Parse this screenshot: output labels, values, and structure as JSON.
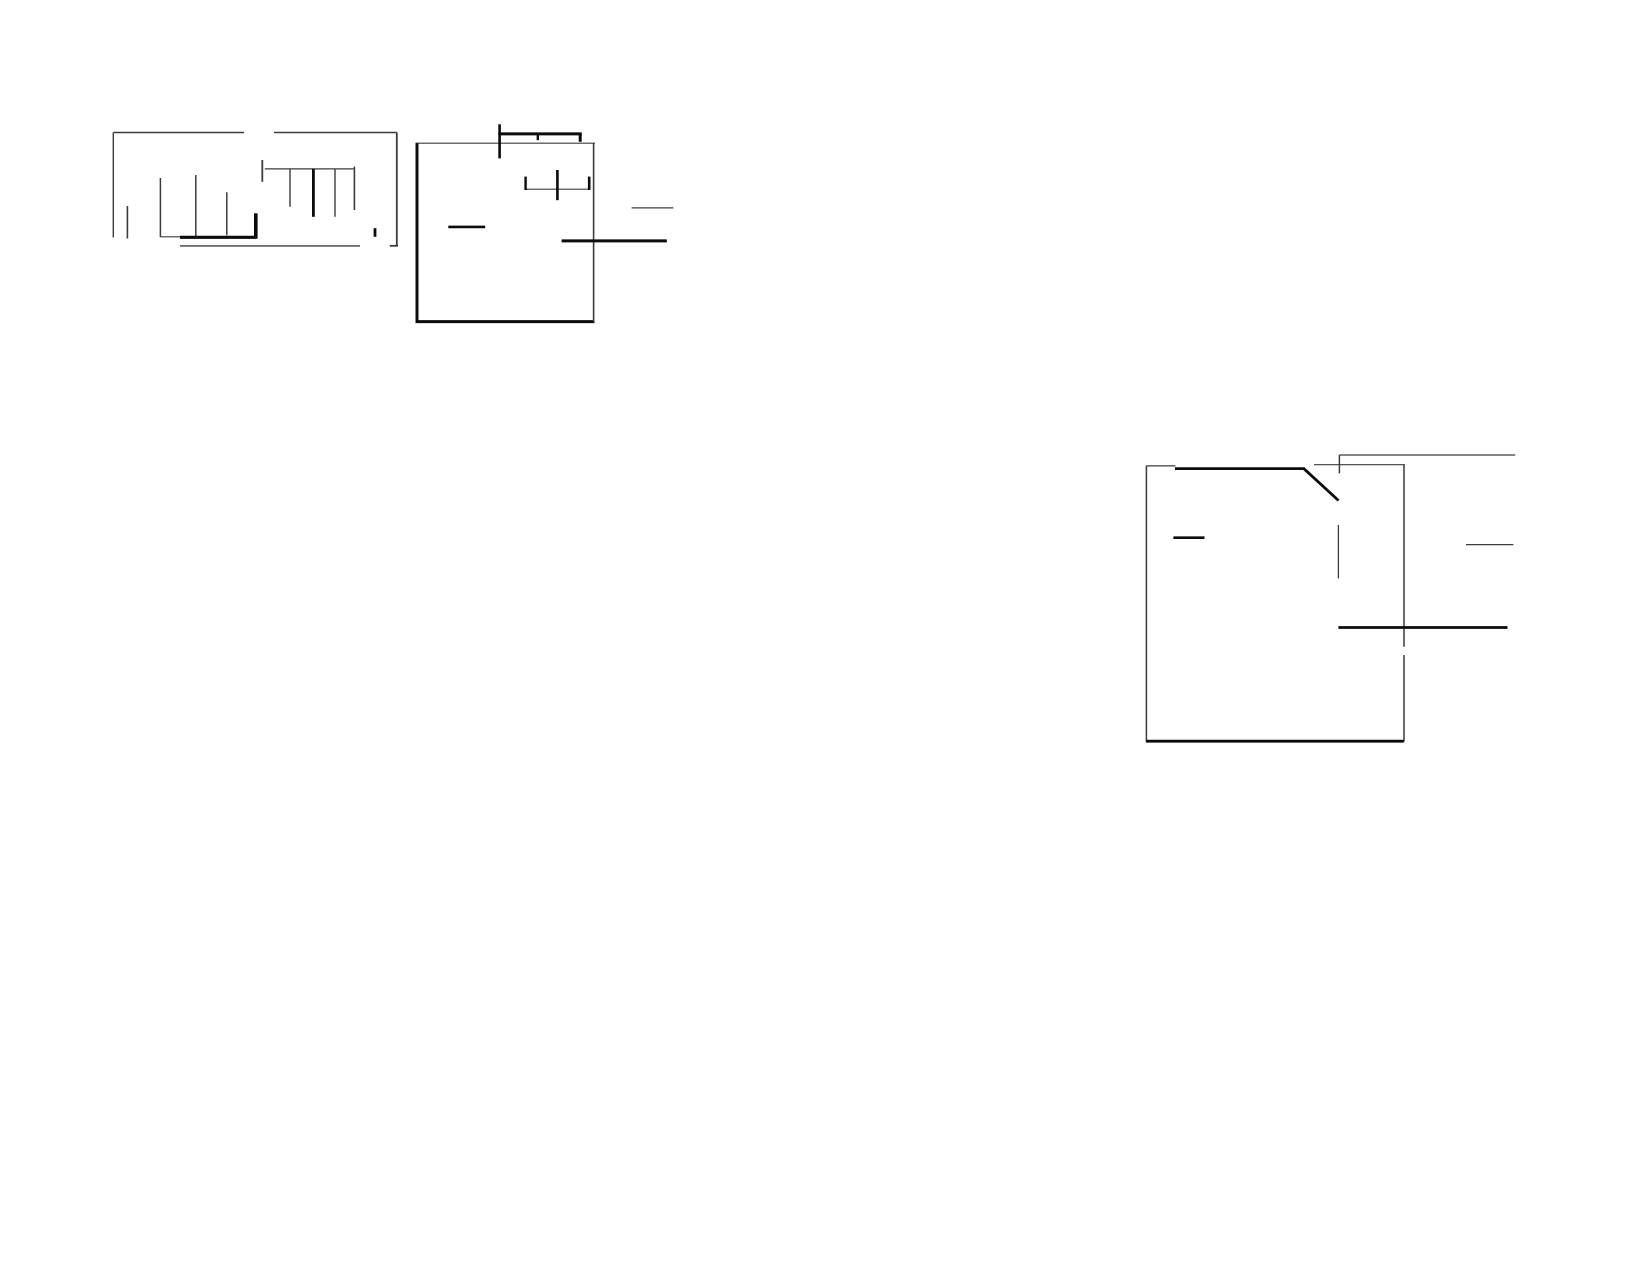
{
  "page": {
    "width": 1650,
    "height": 1275,
    "background": "#ffffff",
    "ink_thick": "#0b0b0b",
    "ink_thin": "#3c3c3c"
  },
  "figures": [
    {
      "name": "top-left-fragment",
      "segments": [
        {
          "name": "outer-top-line-left",
          "x1": 113.3,
          "y1": 132.5,
          "x2": 244.0,
          "y2": 132.5,
          "w": 1.4
        },
        {
          "name": "outer-top-line-right",
          "x1": 274.0,
          "y1": 132.5,
          "x2": 396.8,
          "y2": 132.5,
          "w": 1.4
        },
        {
          "name": "outer-left-edge",
          "x1": 113.3,
          "y1": 132.5,
          "x2": 113.3,
          "y2": 237.5,
          "w": 1.4
        },
        {
          "name": "outer-right-edge",
          "x1": 396.8,
          "y1": 132.5,
          "x2": 396.8,
          "y2": 246.3,
          "w": 1.8
        },
        {
          "name": "outer-right-bottom-hook",
          "x1": 389.8,
          "y1": 245.8,
          "x2": 398.0,
          "y2": 245.8,
          "w": 1.8
        },
        {
          "name": "small-tick-left",
          "x1": 127.4,
          "y1": 206.0,
          "x2": 127.4,
          "y2": 238.5,
          "w": 1.6
        },
        {
          "name": "bar-1",
          "x1": 160.4,
          "y1": 178.0,
          "x2": 160.4,
          "y2": 237.0,
          "w": 1.5
        },
        {
          "name": "base-thin-connector",
          "x1": 160.4,
          "y1": 236.8,
          "x2": 181.0,
          "y2": 236.8,
          "w": 1.2
        },
        {
          "name": "bar-2",
          "x1": 195.8,
          "y1": 175.0,
          "x2": 195.8,
          "y2": 237.0,
          "w": 1.5
        },
        {
          "name": "bar-3",
          "x1": 226.8,
          "y1": 192.3,
          "x2": 226.8,
          "y2": 235.2,
          "w": 1.5
        },
        {
          "name": "thick-corner-vertical",
          "x1": 255.8,
          "y1": 213.3,
          "x2": 255.8,
          "y2": 238.3,
          "w": 3.6
        },
        {
          "name": "thick-base-line",
          "x1": 180.0,
          "y1": 237.3,
          "x2": 257.2,
          "y2": 237.3,
          "w": 3.2
        },
        {
          "name": "bottom-rule",
          "x1": 180.0,
          "y1": 245.9,
          "x2": 360.0,
          "y2": 245.9,
          "w": 1.4
        },
        {
          "name": "comb-horizontal",
          "x1": 264.8,
          "y1": 168.9,
          "x2": 353.5,
          "y2": 168.9,
          "w": 1.2
        },
        {
          "name": "comb-left-tick",
          "x1": 262.3,
          "y1": 160.0,
          "x2": 262.3,
          "y2": 181.8,
          "w": 1.8
        },
        {
          "name": "comb-tooth-1",
          "x1": 290.0,
          "y1": 168.9,
          "x2": 290.0,
          "y2": 206.8,
          "w": 1.4
        },
        {
          "name": "comb-tooth-2-thick",
          "x1": 313.4,
          "y1": 168.9,
          "x2": 313.4,
          "y2": 216.8,
          "w": 2.8
        },
        {
          "name": "comb-tooth-3",
          "x1": 335.0,
          "y1": 168.9,
          "x2": 335.0,
          "y2": 216.8,
          "w": 1.4
        },
        {
          "name": "comb-tooth-4",
          "x1": 354.4,
          "y1": 166.6,
          "x2": 354.4,
          "y2": 210.0,
          "w": 1.6
        },
        {
          "name": "small-tick-right",
          "x1": 375.0,
          "y1": 228.2,
          "x2": 375.0,
          "y2": 236.8,
          "w": 2.8
        }
      ]
    },
    {
      "name": "top-center-fragment",
      "segments": [
        {
          "name": "box-top-edge",
          "x1": 415.5,
          "y1": 143.2,
          "x2": 595.0,
          "y2": 143.2,
          "w": 1.2
        },
        {
          "name": "box-left-edge",
          "x1": 417.0,
          "y1": 143.2,
          "x2": 417.0,
          "y2": 322.3,
          "w": 3.0
        },
        {
          "name": "box-bottom-edge",
          "x1": 415.5,
          "y1": 321.6,
          "x2": 594.5,
          "y2": 321.6,
          "w": 3.0
        },
        {
          "name": "box-right-edge",
          "x1": 593.6,
          "y1": 143.2,
          "x2": 593.6,
          "y2": 322.0,
          "w": 1.6
        },
        {
          "name": "mast-vertical",
          "x1": 499.6,
          "y1": 124.3,
          "x2": 499.6,
          "y2": 158.4,
          "w": 2.6
        },
        {
          "name": "mast-horizontal",
          "x1": 498.3,
          "y1": 133.9,
          "x2": 581.8,
          "y2": 133.9,
          "w": 3.0
        },
        {
          "name": "mast-mid-tick",
          "x1": 537.8,
          "y1": 133.9,
          "x2": 537.8,
          "y2": 140.2,
          "w": 2.4
        },
        {
          "name": "mast-right-hook",
          "x1": 580.2,
          "y1": 133.9,
          "x2": 580.2,
          "y2": 141.8,
          "w": 3.0
        },
        {
          "name": "gauge-horizontal",
          "x1": 524.8,
          "y1": 189.2,
          "x2": 590.2,
          "y2": 189.2,
          "w": 1.2
        },
        {
          "name": "gauge-left-tick",
          "x1": 525.6,
          "y1": 176.6,
          "x2": 525.6,
          "y2": 190.0,
          "w": 2.4
        },
        {
          "name": "gauge-center-vertical",
          "x1": 557.4,
          "y1": 170.0,
          "x2": 557.4,
          "y2": 200.2,
          "w": 2.6
        },
        {
          "name": "gauge-right-tick",
          "x1": 589.2,
          "y1": 176.6,
          "x2": 589.2,
          "y2": 190.0,
          "w": 2.6
        },
        {
          "name": "dash-inside-left",
          "x1": 448.3,
          "y1": 226.9,
          "x2": 485.2,
          "y2": 226.9,
          "w": 2.6
        },
        {
          "name": "lead-long-horizontal",
          "x1": 561.6,
          "y1": 240.9,
          "x2": 666.8,
          "y2": 240.9,
          "w": 3.0
        },
        {
          "name": "lead-short-horizontal",
          "x1": 631.6,
          "y1": 207.9,
          "x2": 673.4,
          "y2": 207.9,
          "w": 1.2
        }
      ]
    },
    {
      "name": "right-fragment",
      "segments": [
        {
          "name": "box-left-edge",
          "x1": 1146.4,
          "y1": 465.9,
          "x2": 1146.4,
          "y2": 741.8,
          "w": 1.5
        },
        {
          "name": "box-top-thin",
          "x1": 1146.4,
          "y1": 465.9,
          "x2": 1175.5,
          "y2": 465.9,
          "w": 1.2
        },
        {
          "name": "box-top-thick",
          "x1": 1175.0,
          "y1": 468.6,
          "x2": 1304.5,
          "y2": 468.6,
          "w": 2.8
        },
        {
          "name": "diagonal-stroke",
          "x1": 1303.5,
          "y1": 468.3,
          "x2": 1338.5,
          "y2": 500.5,
          "w": 2.8
        },
        {
          "name": "top-corner-tick",
          "x1": 1339.4,
          "y1": 455.0,
          "x2": 1339.4,
          "y2": 473.4,
          "w": 1.5
        },
        {
          "name": "top-long-line",
          "x1": 1339.4,
          "y1": 455.0,
          "x2": 1515.2,
          "y2": 455.0,
          "w": 1.2
        },
        {
          "name": "top-connector",
          "x1": 1314.0,
          "y1": 464.7,
          "x2": 1405.0,
          "y2": 464.7,
          "w": 1.2
        },
        {
          "name": "box-right-edge-upper",
          "x1": 1404.0,
          "y1": 464.7,
          "x2": 1404.0,
          "y2": 646.8,
          "w": 1.5
        },
        {
          "name": "box-right-edge-lower",
          "x1": 1404.0,
          "y1": 655.0,
          "x2": 1404.0,
          "y2": 741.6,
          "w": 1.5
        },
        {
          "name": "box-bottom-edge",
          "x1": 1146.0,
          "y1": 741.2,
          "x2": 1403.8,
          "y2": 741.2,
          "w": 2.8
        },
        {
          "name": "dash-inside-left",
          "x1": 1173.4,
          "y1": 537.7,
          "x2": 1204.5,
          "y2": 537.7,
          "w": 2.6
        },
        {
          "name": "center-stub-vertical",
          "x1": 1338.4,
          "y1": 525.0,
          "x2": 1338.4,
          "y2": 578.4,
          "w": 1.3
        },
        {
          "name": "lead-long-horizontal",
          "x1": 1338.4,
          "y1": 627.5,
          "x2": 1507.5,
          "y2": 627.5,
          "w": 2.8
        },
        {
          "name": "lead-short-horizontal",
          "x1": 1466.0,
          "y1": 544.6,
          "x2": 1513.4,
          "y2": 544.6,
          "w": 1.2
        }
      ]
    }
  ]
}
